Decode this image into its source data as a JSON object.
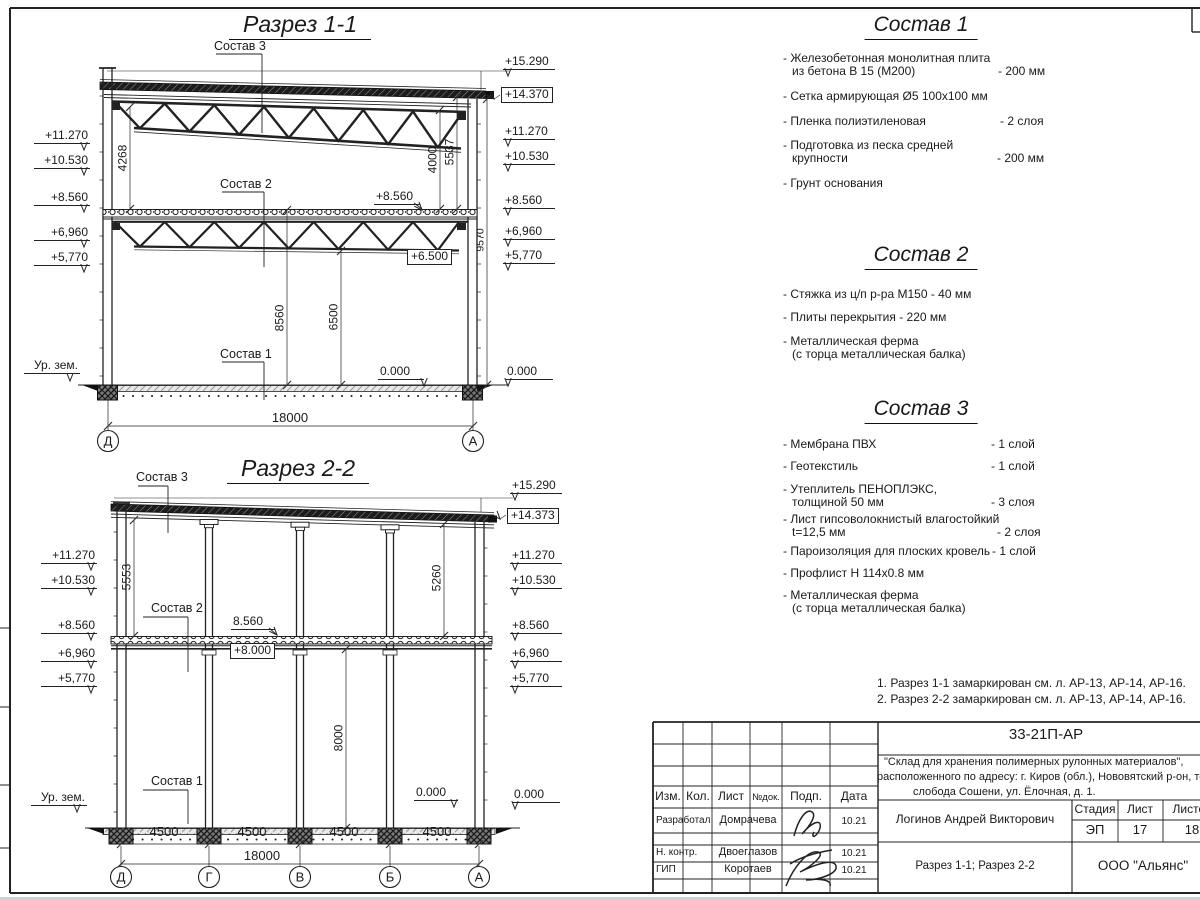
{
  "section1": {
    "title": "Разрез 1-1",
    "label_sostav3": "Состав 3",
    "label_sostav2": "Состав 2",
    "label_sostav1": "Состав 1",
    "left_marks": [
      "+11.270",
      "+10.530",
      "+8.560",
      "+6,960",
      "+5,770"
    ],
    "ground_label": "Ур. зем.",
    "right_marks": [
      "+15.290",
      "+14.370",
      "+11.270",
      "+10.530",
      "+8.560",
      "+6,960",
      "+5,770",
      "0.000"
    ],
    "inner_marks": {
      "m8560": "+8.560",
      "m6500": "+6.500",
      "m0": "0.000"
    },
    "dims": {
      "v4268": "4268",
      "v8560": "8560",
      "v6500": "6500",
      "v4000": "4000",
      "v5537": "5537",
      "v9570": "9570",
      "total": "18000"
    },
    "bubbles": [
      "Д",
      "А"
    ]
  },
  "section2": {
    "title": "Разрез 2-2",
    "label_sostav3": "Состав 3",
    "label_sostav2": "Состав 2",
    "label_sostav1": "Состав 1",
    "left_marks": [
      "+11.270",
      "+10.530",
      "+8.560",
      "+6,960",
      "+5,770"
    ],
    "ground_label": "Ур. зем.",
    "right_marks": [
      "+15.290",
      "+14.373",
      "+11.270",
      "+10.530",
      "+8.560",
      "+6,960",
      "+5,770",
      "0.000"
    ],
    "inner_marks": {
      "m8560": "8.560",
      "m8000": "+8.000",
      "m0": "0.000"
    },
    "dims": {
      "v5553": "5553",
      "v5260": "5260",
      "v8000": "8000",
      "spans": [
        "4500",
        "4500",
        "4500",
        "4500"
      ],
      "total": "18000"
    },
    "bubbles": [
      "Д",
      "Г",
      "В",
      "Б",
      "А"
    ]
  },
  "sostav1": {
    "title": "Состав 1",
    "items": [
      {
        "name": "- Железобетонная  монолитная плита\nиз бетона В 15 (М200)",
        "value": "- 200 мм"
      },
      {
        "name": "- Сетка армирующая Ø5 100х100 мм",
        "value": ""
      },
      {
        "name": "- Пленка полиэтиленовая",
        "value": "-  2 слоя"
      },
      {
        "name": "- Подготовка из песка средней\nкрупности",
        "value": "- 200 мм"
      },
      {
        "name": "- Грунт основания",
        "value": ""
      }
    ]
  },
  "sostav2": {
    "title": "Состав 2",
    "items": [
      {
        "name": "- Стяжка из ц/п р-ра М150 - 40 мм",
        "value": ""
      },
      {
        "name": "- Плиты перекрытия - 220 мм",
        "value": ""
      },
      {
        "name": "- Металлическая ферма\n(с торца металлическая балка)",
        "value": ""
      }
    ]
  },
  "sostav3": {
    "title": "Состав 3",
    "items": [
      {
        "name": "- Мембрана ПВХ",
        "value": "- 1 слой"
      },
      {
        "name": "- Геотекстиль",
        "value": "- 1 слой"
      },
      {
        "name": "- Утеплитель ПЕНОПЛЭКС,\nтолщиной 50 мм",
        "value": "- 3 слоя"
      },
      {
        "name": "- Лист гипсоволокнистый влагостойкий\nt=12,5 мм",
        "value": "- 2 слоя"
      },
      {
        "name": "- Пароизоляция для плоских кровель",
        "value": "- 1 слой"
      },
      {
        "name": "- Профлист Н 114х0.8 мм",
        "value": ""
      },
      {
        "name": "- Металлическая ферма\n(с торца металлическая балка)",
        "value": ""
      }
    ]
  },
  "notes": [
    "1. Разрез 1-1 замаркирован см. л. АР-13, АР-14, АР-16.",
    "2. Разрез 2-2 замаркирован см. л. АР-13, АР-14, АР-16."
  ],
  "titleblock": {
    "doc_number": "33-21П-АР",
    "project_line1": "\"Склад для хранения полимерных рулонных материалов\",",
    "project_line2": "расположенного по адресу: г. Киров (обл.), Нововятский р-он, те",
    "project_line3": "слобода Сошени, ул. Ёлочная, д. 1.",
    "col_izm": "Изм.",
    "col_kol": "Кол.",
    "col_list": "Лист",
    "col_ndoc": "№док.",
    "col_podp": "Подп.",
    "col_data": "Дата",
    "row1_role": "Разработал",
    "row1_name": "Домрачева",
    "row1_date": "10.21",
    "row2_role": "Н. контр.",
    "row2_name": "Двоеглазов",
    "row2_date": "10.21",
    "row3_role": "ГИП",
    "row3_name": "Коротаев",
    "row3_date": "10.21",
    "author": "Логинов Андрей Викторович",
    "stage_label": "Стадия",
    "sheet_label": "Лист",
    "sheets_label": "Листов",
    "stage_value": "ЭП",
    "sheet_value": "17",
    "sheets_value": "18",
    "content_title": "Разрез 1-1; Разрез 2-2",
    "company": "ООО \"Альянс\""
  }
}
